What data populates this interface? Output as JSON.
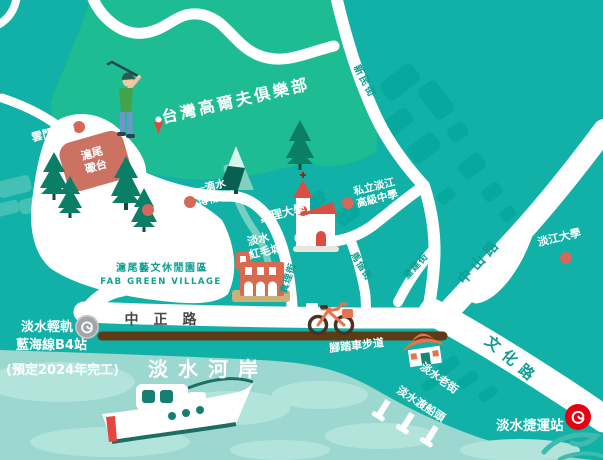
{
  "labels": {
    "golf_club": "台灣高爾夫俱樂部",
    "cloud_gate": "雲門劇場",
    "hobe_fort_l1": "滬尾",
    "hobe_fort_l2": "礮台",
    "peace_park_l1": "和平",
    "peace_park_l2": "公園",
    "drop_museum_l1": "一滴水",
    "drop_museum_l2": "博物館",
    "aletheia_univ": "真理大學",
    "red_castle_l1": "淡水",
    "red_castle_l2": "紅毛城",
    "tamkang_hs_l1": "私立淡江",
    "tamkang_hs_l2": "高級中學",
    "tamkang_univ": "淡江大學",
    "fab_zh": "滬尾藝文休閒園區",
    "fab_en": "FAB GREEN VILLAGE",
    "zhongzheng_rd": "中正路",
    "wenhua_rd": "文化路",
    "zhongshan_rd": "中山路",
    "xinmin_st": "新民街",
    "zhenli_st": "真理街",
    "makai_st": "馬偕街",
    "chongjian_st": "重建街",
    "bike_path": "腳踏車步道",
    "old_street": "淡水老街",
    "ferry_pier": "淡水渡船頭",
    "riverside": "淡水河岸",
    "lrt_l1": "淡水輕軌",
    "lrt_l2": "藍海線B4站",
    "lrt_l3": "(預定2024年完工)",
    "mrt_station": "淡水捷運站"
  },
  "colors": {
    "background_teal": "#12b1a7",
    "golf_green": "#1dbc92",
    "water": "#9cd8d0",
    "water_light": "#b2e4dc",
    "road_white": "#ffffff",
    "bike_path_brown": "#5e3b17",
    "poi_salmon": "#d4685a",
    "fort_salmon": "#cb7263",
    "mrt_red": "#e60012",
    "lrt_grey": "#a0a5a8",
    "street_label_teal": "#0f9e94",
    "zhongzheng_label_grey": "#474747"
  }
}
